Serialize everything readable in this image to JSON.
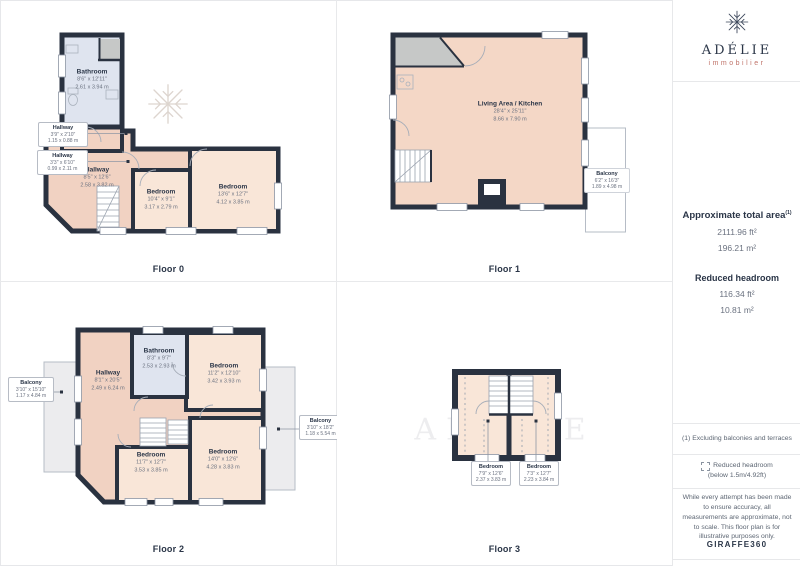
{
  "watermark": {
    "letters": "ADÉLIE",
    "sub": "immobilier"
  },
  "colors": {
    "wall": "#2a3240",
    "room": "#f9e6d8",
    "hallway": "#f1d2c2",
    "bathroom": "#dfe4ef",
    "balcony_gray": "#ececee",
    "navy_text": "#2a3547",
    "dim_text": "#6b7280",
    "brand_red": "#c0746a"
  },
  "floors": [
    {
      "label": "Floor 0",
      "rooms": {
        "bathroom": {
          "name": "Bathroom",
          "ft": "8'6\" x 12'11\"",
          "m": "2.61 x 3.94 m"
        },
        "hall1": {
          "name": "Hallway",
          "ft": "3'9\" x 2'10\"",
          "m": "1.15 x 0.88 m"
        },
        "hall2": {
          "name": "Hallway",
          "ft": "3'3\" x 6'10\"",
          "m": "0.99 x 2.11 m"
        },
        "hallway": {
          "name": "Hallway",
          "ft": "8'5\" x 12'6\"",
          "m": "2.58 x 3.82 m"
        },
        "bed1": {
          "name": "Bedroom",
          "ft": "10'4\" x 9'1\"",
          "m": "3.17 x 2.79 m"
        },
        "bed2": {
          "name": "Bedroom",
          "ft": "13'6\" x 12'7\"",
          "m": "4.12 x 3.85 m"
        }
      }
    },
    {
      "label": "Floor 1",
      "rooms": {
        "living": {
          "name": "Living Area / Kitchen",
          "ft": "28'4\" x 25'11\"",
          "m": "8.66 x 7.90 m"
        },
        "balcony": {
          "name": "Balcony",
          "ft": "6'2\" x 16'3\"",
          "m": "1.89 x 4.98 m"
        }
      }
    },
    {
      "label": "Floor 2",
      "rooms": {
        "balcony_left": {
          "name": "Balcony",
          "ft": "3'10\" x 15'10\"",
          "m": "1.17 x 4.84 m"
        },
        "hallway": {
          "name": "Hallway",
          "ft": "8'1\" x 20'5\"",
          "m": "2.49 x 6.24 m"
        },
        "bathroom": {
          "name": "Bathroom",
          "ft": "8'3\" x 9'7\"",
          "m": "2.53 x 2.93 m"
        },
        "bed_tr": {
          "name": "Bedroom",
          "ft": "11'2\" x 12'10\"",
          "m": "3.42 x 3.93 m"
        },
        "bed_bm": {
          "name": "Bedroom",
          "ft": "11'7\" x 12'7\"",
          "m": "3.53 x 3.85 m"
        },
        "bed_br": {
          "name": "Bedroom",
          "ft": "14'0\" x 12'6\"",
          "m": "4.28 x 3.83 m"
        },
        "balcony_right": {
          "name": "Balcony",
          "ft": "3'10\" x 18'2\"",
          "m": "1.18 x 5.54 m"
        }
      }
    },
    {
      "label": "Floor 3",
      "rooms": {
        "bed_left": {
          "name": "Bedroom",
          "ft": "7'9\" x 12'6\"",
          "m": "2.37 x 3.83 m"
        },
        "bed_right": {
          "name": "Bedroom",
          "ft": "7'3\" x 12'7\"",
          "m": "2.23 x 3.84 m"
        }
      }
    }
  ],
  "sidebar": {
    "brand": {
      "name": "ADÉLIE",
      "tagline": "immobilier"
    },
    "area_title": "Approximate total area",
    "area_sup": "(1)",
    "area_ft": "2111.96 ft²",
    "area_m": "196.21 m²",
    "headroom_title": "Reduced headroom",
    "headroom_ft": "116.34 ft²",
    "headroom_m": "10.81 m²",
    "footnote": "(1) Excluding balconies and terraces",
    "legend_label": "Reduced headroom",
    "legend_sub": "(below 1.5m/4.92ft)",
    "disclaimer": "While every attempt has been made to ensure accuracy, all measurements are approximate, not to scale. This floor plan is for illustrative purposes only.",
    "brand_giraffe": "GIRAFFE",
    "brand_360": "360"
  }
}
